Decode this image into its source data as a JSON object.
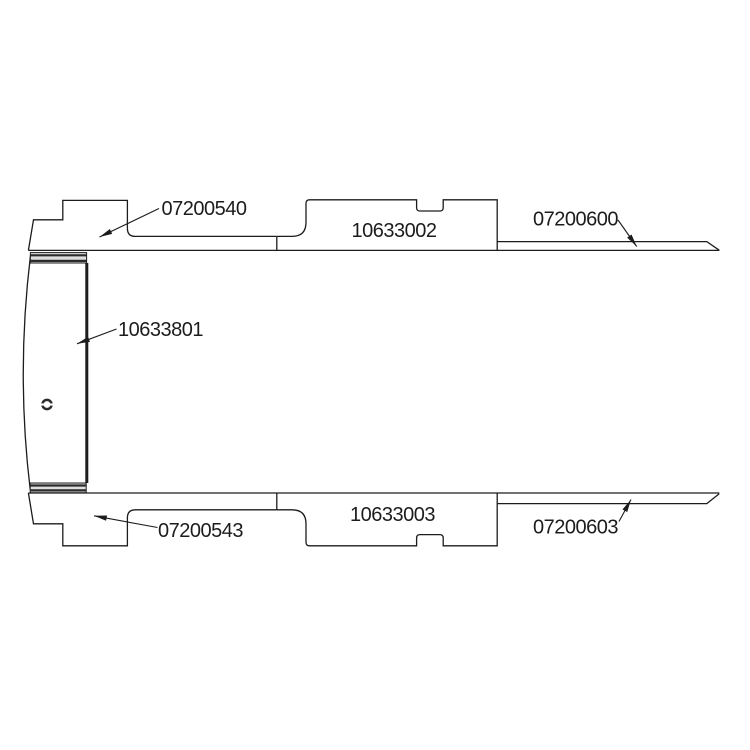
{
  "diagram": {
    "background": "#ffffff",
    "line_color": "#1c1c1c",
    "text_color": "#1c1c1c",
    "labels": {
      "top_left_panel": "07200540",
      "top_middle_panel": "10633002",
      "top_right_strip": "07200600",
      "side_panel": "10633801",
      "bottom_left_panel": "07200543",
      "bottom_middle_panel": "10633003",
      "bottom_right_strip": "07200603"
    }
  }
}
